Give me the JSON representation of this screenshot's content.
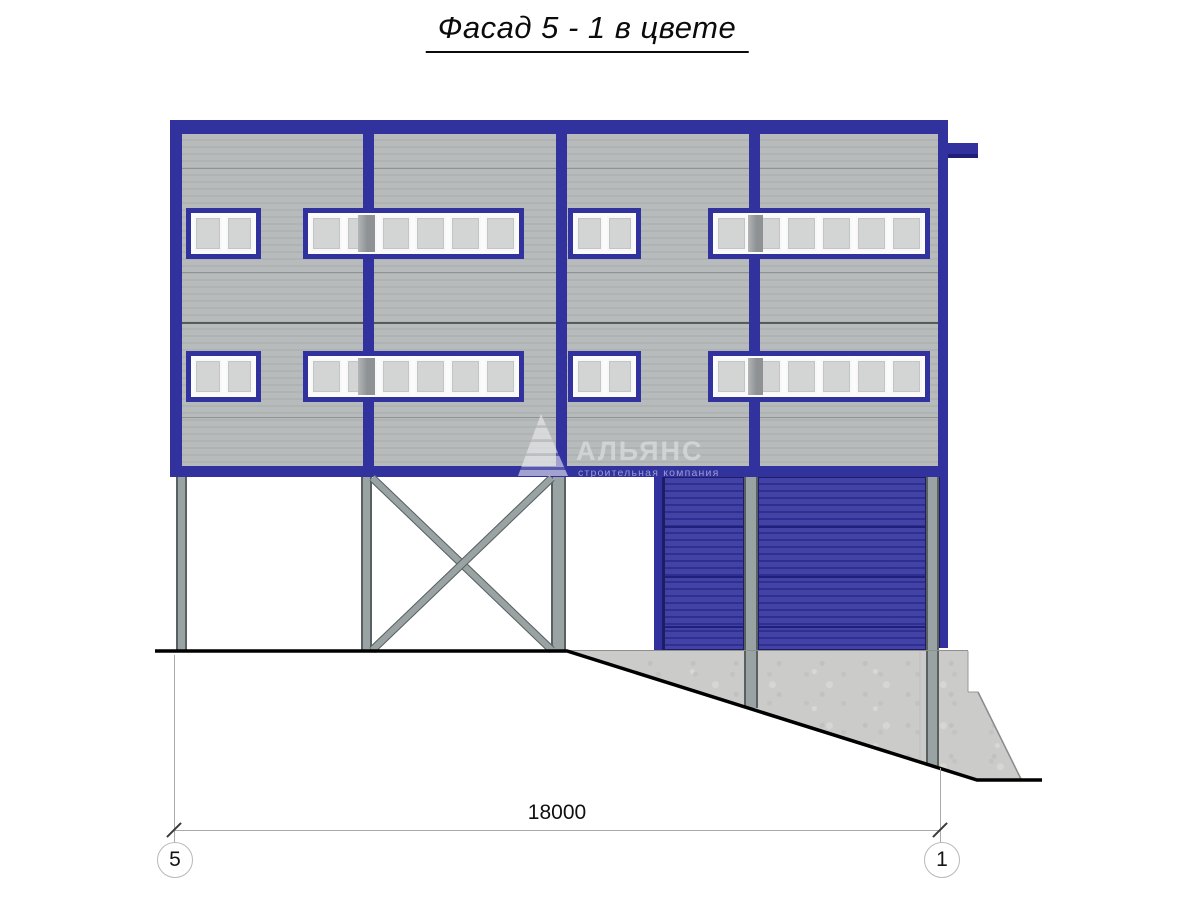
{
  "title": "Фасад 5 - 1 в цвете",
  "watermark": {
    "logo": "sail-logo",
    "name": "АЛЬЯНС",
    "tagline": "строительная компания"
  },
  "dimension": {
    "value": "18000"
  },
  "axes": [
    {
      "label": "5"
    },
    {
      "label": "1"
    }
  ],
  "colors": {
    "frame_blue": "#32329e",
    "door_blue": "#3434a0",
    "siding_gray": "#b5b8b8",
    "siding_seam": "#8f9292",
    "glass_gray": "#d3d5d5",
    "dark_pane": "#8e9295",
    "column_gray": "#9aa3a3",
    "column_edge": "#5a6060",
    "concrete_gray": "#cbcbca",
    "ground_black": "#000000",
    "dim_line_gray": "#aaaaaa"
  }
}
